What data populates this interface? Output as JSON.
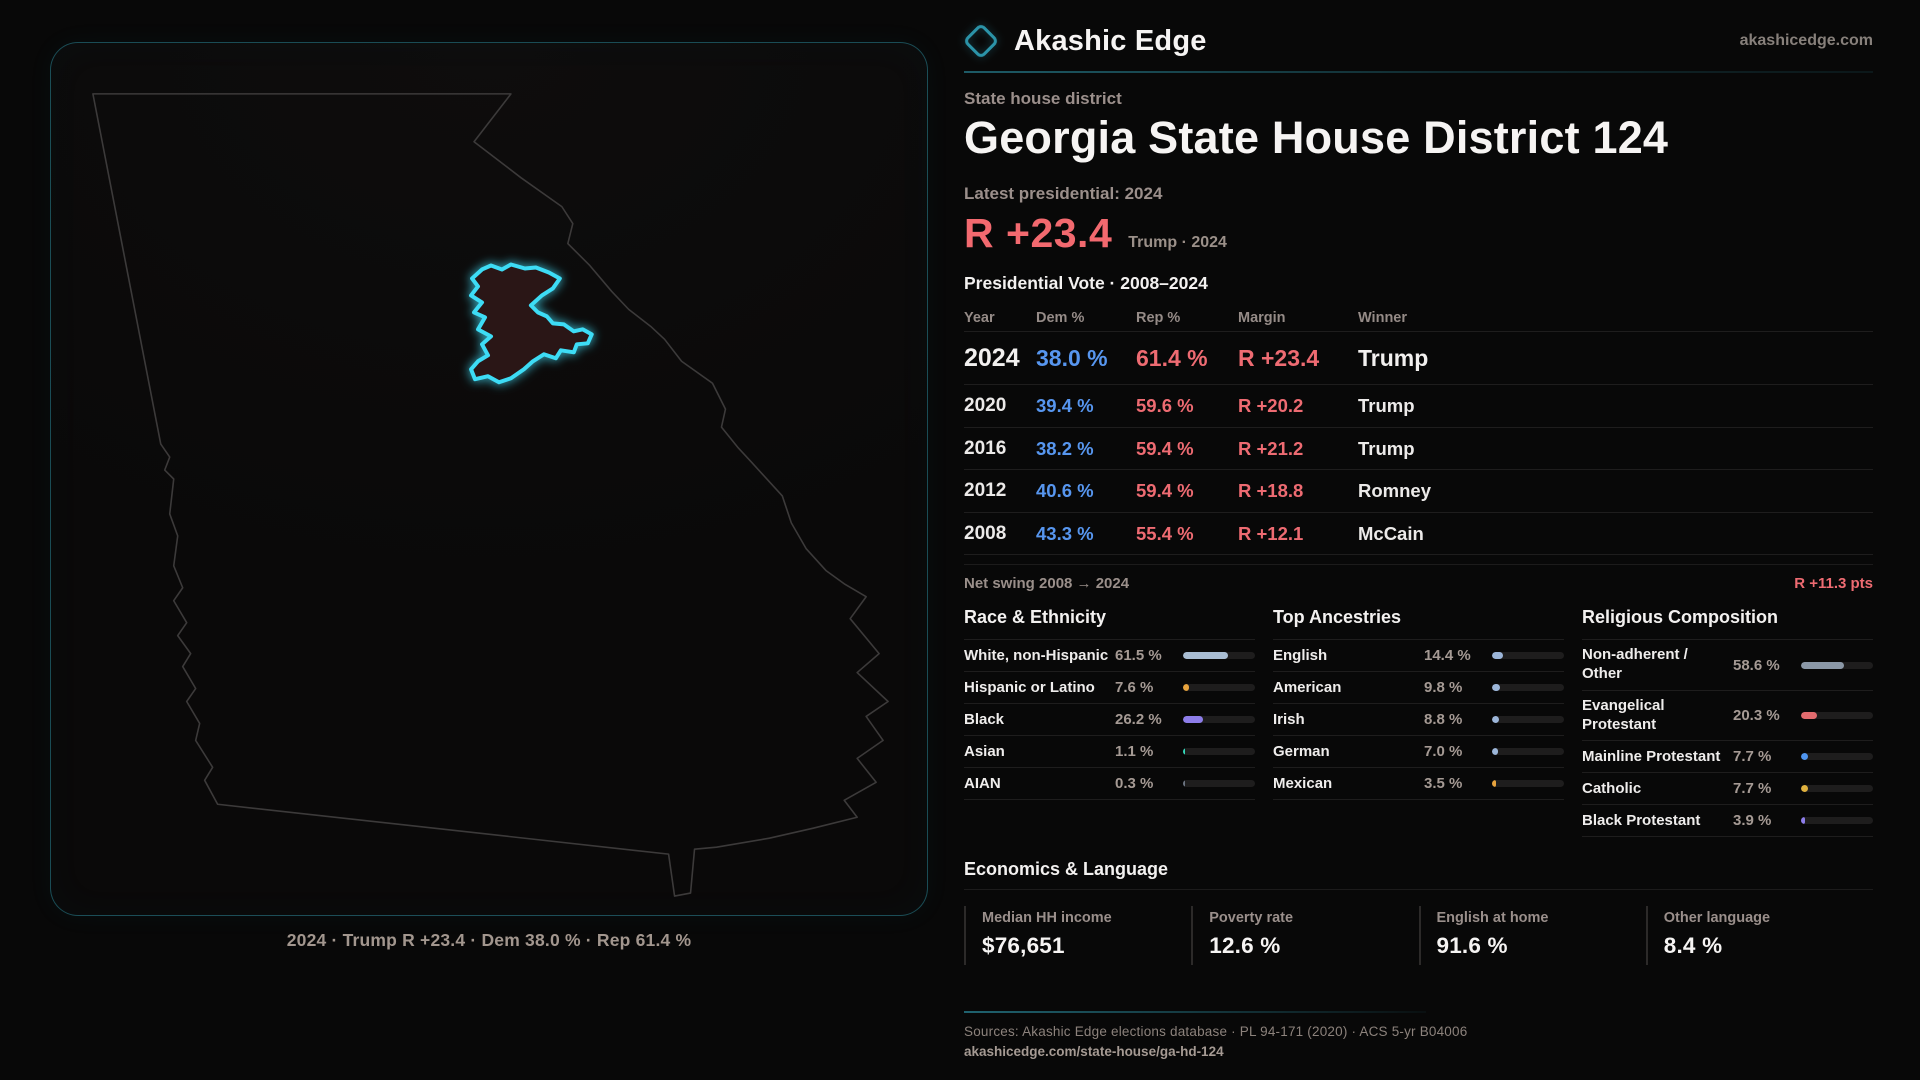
{
  "brand": {
    "name": "Akashic Edge",
    "domain": "akashicedge.com",
    "logo_icon": "diamond-outline-icon"
  },
  "page": {
    "kicker": "State house district",
    "title": "Georgia State House District 124",
    "latest_label": "Latest presidential: 2024",
    "headline_margin": "R +23.4",
    "headline_note": "Trump · 2024"
  },
  "map": {
    "caption": "2024 · Trump R +23.4 · Dem 38.0 % · Rep 61.4 %",
    "state": "Georgia",
    "district_fill": "#2a1517",
    "district_stroke": "#3ddcf5",
    "state_outline_color": "#3c3a3a"
  },
  "vote_table": {
    "title": "Presidential Vote · 2008–2024",
    "columns": [
      "Year",
      "Dem %",
      "Rep %",
      "Margin",
      "Winner"
    ],
    "rows": [
      {
        "year": "2024",
        "dem": "38.0 %",
        "rep": "61.4 %",
        "margin": "R +23.4",
        "winner": "Trump",
        "highlight": true
      },
      {
        "year": "2020",
        "dem": "39.4 %",
        "rep": "59.6 %",
        "margin": "R +20.2",
        "winner": "Trump",
        "highlight": false
      },
      {
        "year": "2016",
        "dem": "38.2 %",
        "rep": "59.4 %",
        "margin": "R +21.2",
        "winner": "Trump",
        "highlight": false
      },
      {
        "year": "2012",
        "dem": "40.6 %",
        "rep": "59.4 %",
        "margin": "R +18.8",
        "winner": "Romney",
        "highlight": false
      },
      {
        "year": "2008",
        "dem": "43.3 %",
        "rep": "55.4 %",
        "margin": "R +12.1",
        "winner": "McCain",
        "highlight": false
      }
    ],
    "net_swing_label": "Net swing 2008 → 2024",
    "net_swing_value": "R +11.3 pts"
  },
  "demographics": [
    {
      "title": "Race & Ethnicity",
      "rows": [
        {
          "label": "White, non-Hispanic",
          "value": "61.5 %",
          "pct": 61.5,
          "color": "#a9bdd3"
        },
        {
          "label": "Hispanic or Latino",
          "value": "7.6 %",
          "pct": 7.6,
          "color": "#e8a33d"
        },
        {
          "label": "Black",
          "value": "26.2 %",
          "pct": 26.2,
          "color": "#8d7de9"
        },
        {
          "label": "Asian",
          "value": "1.1 %",
          "pct": 1.1,
          "color": "#35d6b8"
        },
        {
          "label": "AIAN",
          "value": "0.3 %",
          "pct": 0.3,
          "color": "#6b7380"
        }
      ]
    },
    {
      "title": "Top Ancestries",
      "rows": [
        {
          "label": "English",
          "value": "14.4 %",
          "pct": 14.4,
          "color": "#9cb6d9"
        },
        {
          "label": "American",
          "value": "9.8 %",
          "pct": 9.8,
          "color": "#9cb6d9"
        },
        {
          "label": "Irish",
          "value": "8.8 %",
          "pct": 8.8,
          "color": "#9cb6d9"
        },
        {
          "label": "German",
          "value": "7.0 %",
          "pct": 7.0,
          "color": "#9cb6d9"
        },
        {
          "label": "Mexican",
          "value": "3.5 %",
          "pct": 3.5,
          "color": "#e8a33d"
        }
      ]
    },
    {
      "title": "Religious Composition",
      "rows": [
        {
          "label": "Non-adherent / Other",
          "value": "58.6 %",
          "pct": 58.6,
          "color": "#8b98a7"
        },
        {
          "label": "Evangelical Protestant",
          "value": "20.3 %",
          "pct": 20.3,
          "color": "#e26b6e"
        },
        {
          "label": "Mainline Protestant",
          "value": "7.7 %",
          "pct": 7.7,
          "color": "#4f95ef"
        },
        {
          "label": "Catholic",
          "value": "7.7 %",
          "pct": 7.7,
          "color": "#dfb13e"
        },
        {
          "label": "Black Protestant",
          "value": "3.9 %",
          "pct": 3.9,
          "color": "#8d7de9"
        }
      ]
    }
  ],
  "economics": {
    "title": "Economics & Language",
    "stats": [
      {
        "label": "Median HH income",
        "value": "$76,651"
      },
      {
        "label": "Poverty rate",
        "value": "12.6 %"
      },
      {
        "label": "English at home",
        "value": "91.6 %"
      },
      {
        "label": "Other language",
        "value": "8.4 %"
      }
    ]
  },
  "footer": {
    "sources": "Sources: Akashic Edge elections database · PL 94-171 (2020) · ACS 5-yr B04006",
    "permalink": "akashicedge.com/state-house/ga-hd-124"
  },
  "colors": {
    "accent_teal": "#2f9fb4",
    "district_cyan": "#3ddcf5",
    "dem_blue": "#5796ef",
    "rep_red": "#ee6b72",
    "background": "#080808"
  }
}
